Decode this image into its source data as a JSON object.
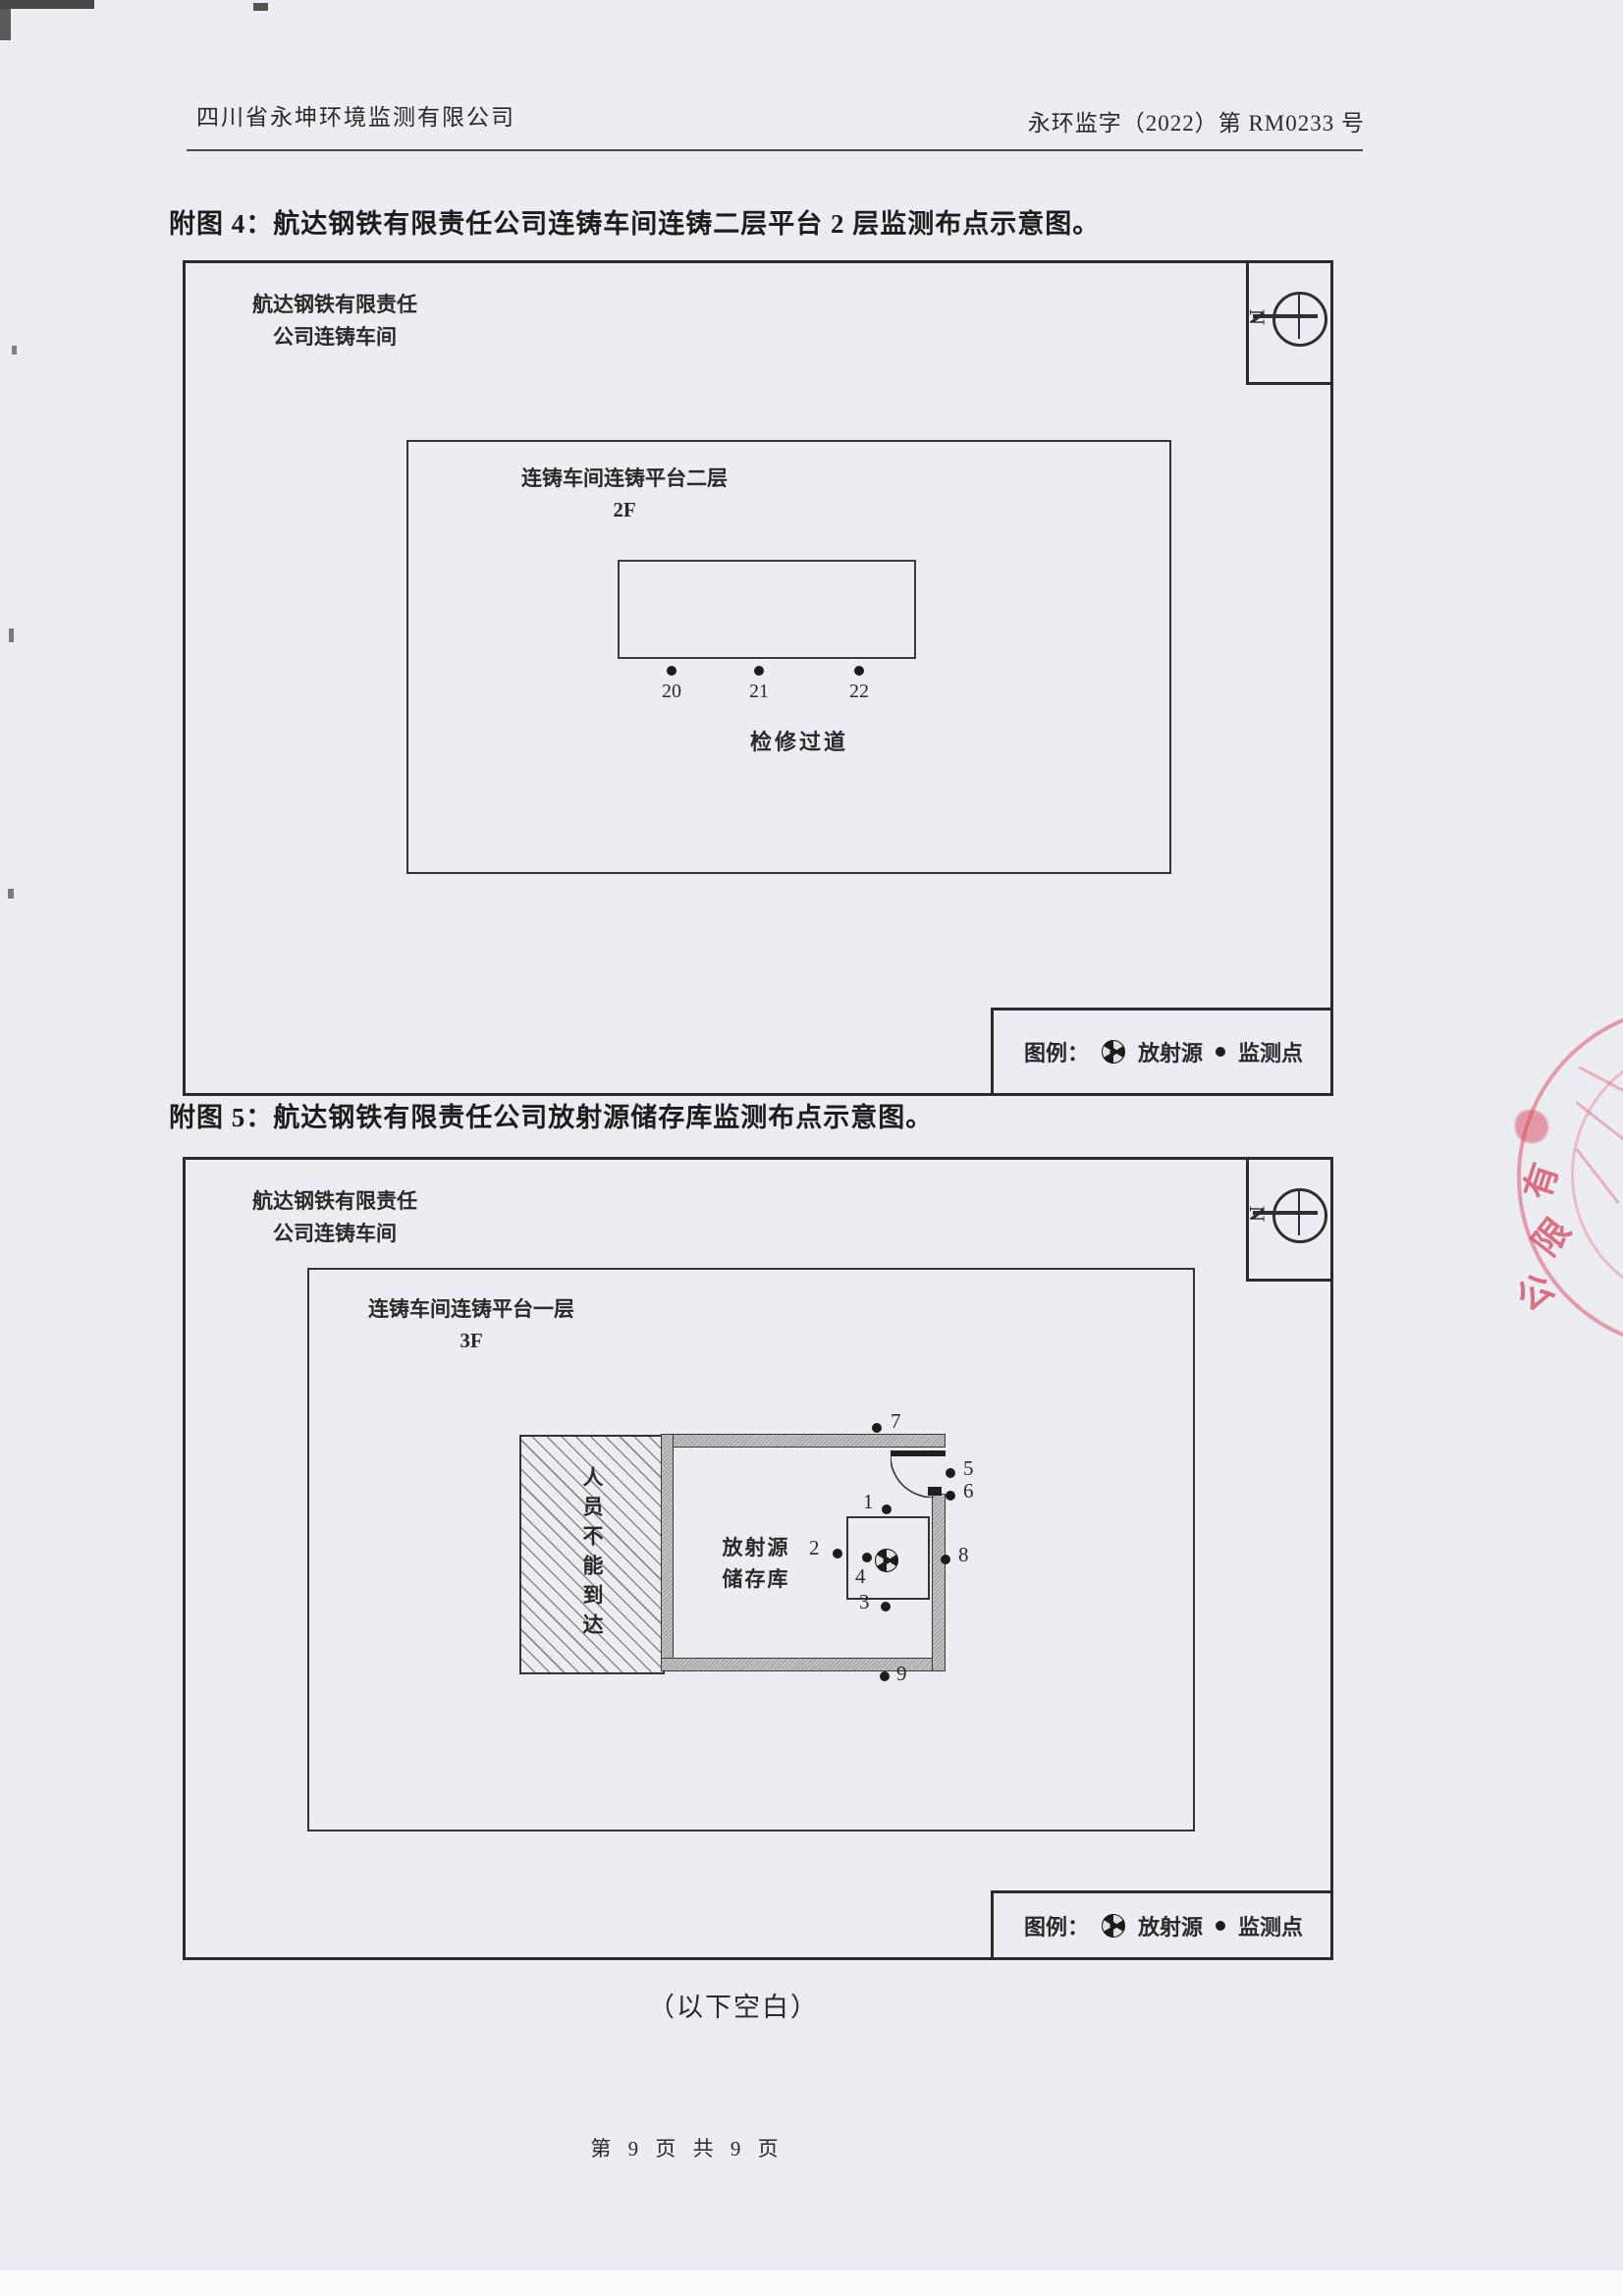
{
  "header": {
    "company": "四川省永坤环境监测有限公司",
    "doc_number": "永环监字（2022）第 RM0233 号"
  },
  "figure4": {
    "title": "附图 4：航达钢铁有限责任公司连铸车间连铸二层平台 2 层监测布点示意图。",
    "corp_line1": "航达钢铁有限责任",
    "corp_line2": "公司连铸车间",
    "area_line1": "连铸车间连铸平台二层",
    "area_line2": "2F",
    "walkway": "检修过道",
    "north": "N",
    "points": [
      "20",
      "21",
      "22"
    ]
  },
  "figure5": {
    "title": "附图 5：航达钢铁有限责任公司放射源储存库监测布点示意图。",
    "corp_line1": "航达钢铁有限责任",
    "corp_line2": "公司连铸车间",
    "area_line1": "连铸车间连铸平台一层",
    "area_line2": "3F",
    "restricted": "人员不能到达",
    "storage_line1": "放射源",
    "storage_line2": "储存库",
    "north": "N",
    "points": [
      "1",
      "2",
      "3",
      "4",
      "5",
      "6",
      "7",
      "8",
      "9"
    ]
  },
  "legend": {
    "caption": "图例：",
    "source_label": "放射源",
    "monitor_label": "监测点"
  },
  "footer": {
    "page_text": "第 9 页 共 9 页",
    "blank_note": "（以下空白）"
  },
  "stamp": {
    "chars": [
      "有",
      "限",
      "公"
    ],
    "color": "#d33e56"
  },
  "colors": {
    "paper": "#ecedf2",
    "line": "#2b2b2b",
    "wall_gray": "#c2c2c2",
    "stamp_red": "#e0566c"
  }
}
